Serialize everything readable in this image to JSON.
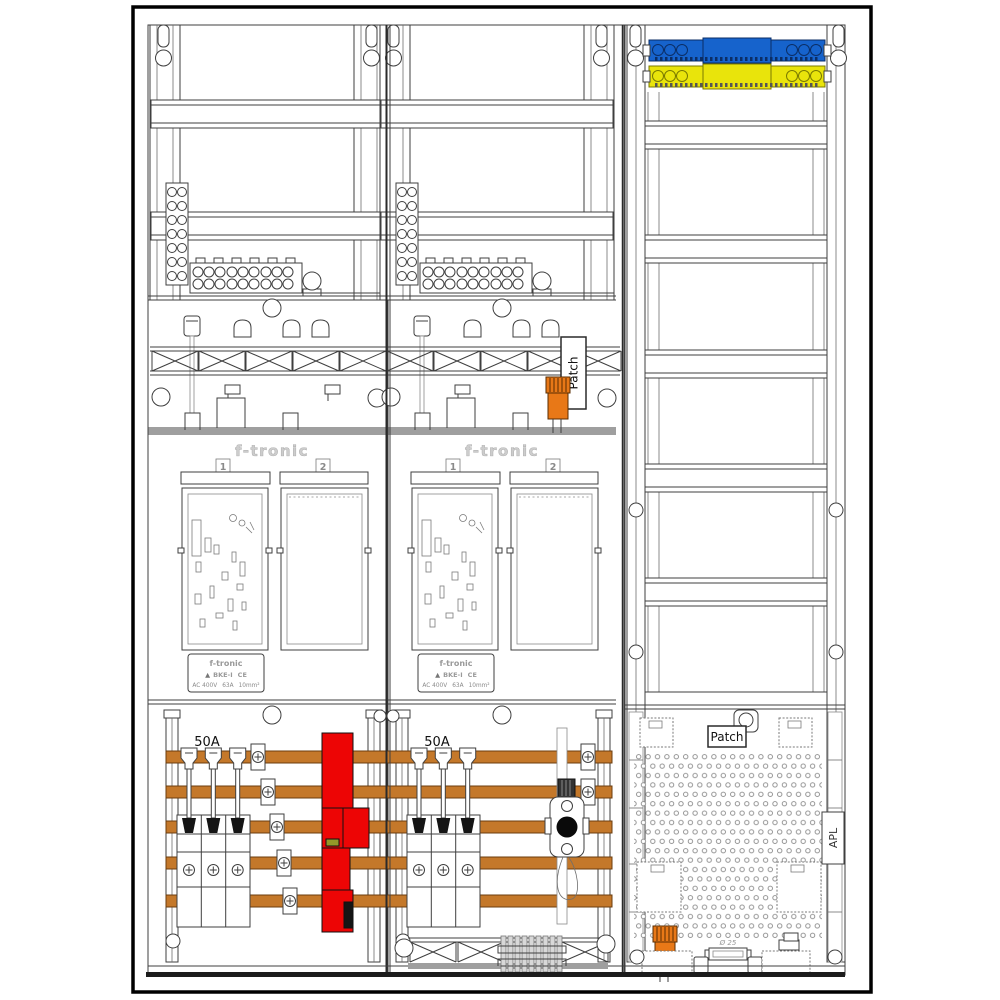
{
  "panels": [
    {
      "brand": "f-tronic",
      "field_labels": [
        "1",
        "2"
      ],
      "breaker_rating": "50A",
      "plate": {
        "brand": "f-tronic",
        "type": "BKE-I",
        "ce": "CE",
        "voltage": "AC 400V",
        "current": "63A",
        "cross_section": "10mm²"
      }
    },
    {
      "brand": "f-tronic",
      "field_labels": [
        "1",
        "2"
      ],
      "breaker_rating": "50A",
      "plate": {
        "brand": "f-tronic",
        "type": "BKE-I",
        "ce": "CE",
        "voltage": "AC 400V",
        "current": "63A",
        "cross_section": "10mm²"
      }
    }
  ],
  "labels": {
    "patch_meter_area": "Patch",
    "patch_right_panel": "Patch",
    "apl": "APL",
    "knockout_diameter": "Ø 25"
  },
  "icons": {
    "approval_triangle": "▲"
  },
  "colors": {
    "busbar": "#C4782A",
    "sls_red": "#ED0505",
    "neutral_blue": "#1663CC",
    "pe_yellow": "#E9E40B",
    "device_orange": "#E87817",
    "indicator_olive": "#949729"
  }
}
